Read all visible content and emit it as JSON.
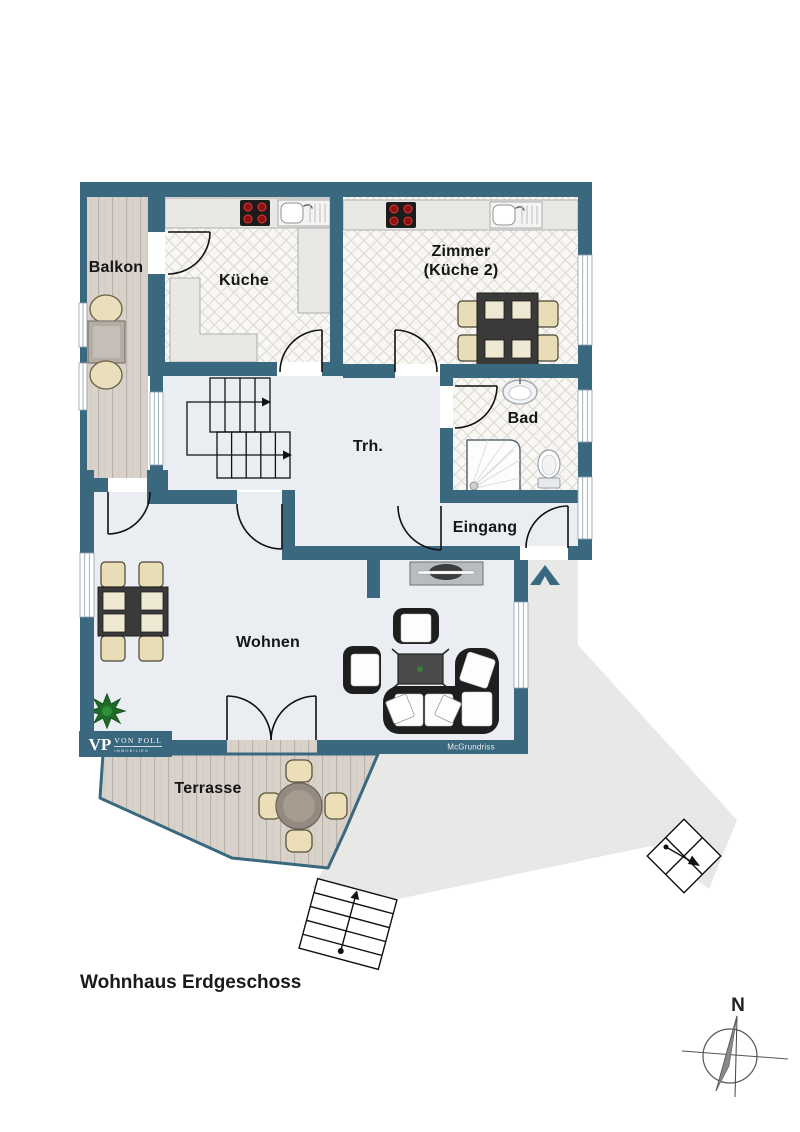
{
  "title": "Wohnhaus Erdgeschoss",
  "watermark": "McGrundriss",
  "compass": {
    "north": "N"
  },
  "logo": {
    "initials": "VP",
    "name": "VON POLL",
    "subtitle": "IMMOBILIEN"
  },
  "rooms": {
    "balkon": "Balkon",
    "kueche": "Küche",
    "zimmer_line1": "Zimmer",
    "zimmer_line2": "(Küche 2)",
    "treppenhaus": "Trh.",
    "bad": "Bad",
    "eingang": "Eingang",
    "wohnen": "Wohnen",
    "terrasse": "Terrasse"
  },
  "colors": {
    "wall": "#3a687f",
    "floor": "#eaeef3",
    "tile_bg": "#f8f7f4",
    "wood": "#d8d2cb",
    "path": "#e8e8e6",
    "logo_bg": "#39677e"
  }
}
